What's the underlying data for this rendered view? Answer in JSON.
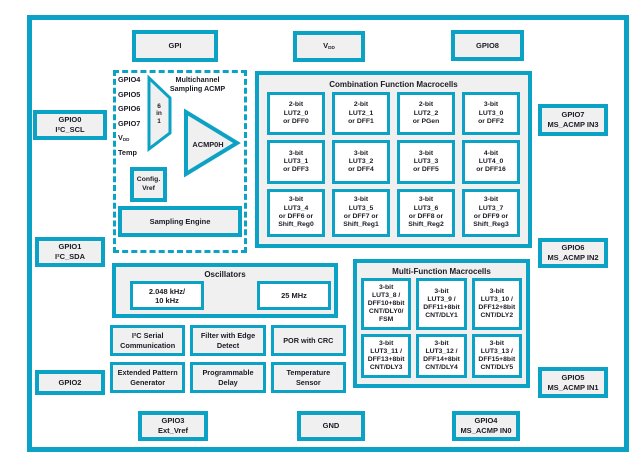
{
  "colors": {
    "accent": "#0ca2c6",
    "box_fill": "#f0f0f0",
    "cell_fill": "#ffffff",
    "text": "#1b1b26",
    "background": "#ffffff"
  },
  "pins": {
    "gpi": "GPI",
    "vdd_main": "V",
    "vdd_sub": "DD",
    "gpio8": "GPIO8",
    "gpio0": "GPIO0\nI²C_SCL",
    "gpio1": "GPIO1\nI²C_SDA",
    "gpio2": "GPIO2",
    "gpio3": "GPIO3\nExt_Vref",
    "gnd": "GND",
    "gpio4": "GPIO4\nMS_ACMP IN0",
    "gpio5": "GPIO5\nMS_ACMP IN1",
    "gpio6": "GPIO6\nMS_ACMP IN2",
    "gpio7": "GPIO7\nMS_ACMP IN3"
  },
  "acmp": {
    "title": "Multichannel\nSampling ACMP",
    "inputs": [
      {
        "main": "GPIO4",
        "sub": ""
      },
      {
        "main": "GPIO5",
        "sub": ""
      },
      {
        "main": "GPIO6",
        "sub": ""
      },
      {
        "main": "GPIO7",
        "sub": ""
      },
      {
        "main": "V",
        "sub": "DD"
      },
      {
        "main": "Temp",
        "sub": ""
      }
    ],
    "mux": "6\nin\n1",
    "comparator": "ACMP0H",
    "config_vref": "Config.\nVref",
    "sampling_engine": "Sampling Engine"
  },
  "comb": {
    "title": "Combination Function Macrocells",
    "cells": [
      "2-bit\nLUT2_0\nor DFF0",
      "2-bit\nLUT2_1\nor DFF1",
      "2-bit\nLUT2_2\nor PGen",
      "3-bit\nLUT3_0\nor DFF2",
      "3-bit\nLUT3_1\nor DFF3",
      "3-bit\nLUT3_2\nor DFF4",
      "3-bit\nLUT3_3\nor DFF5",
      "4-bit\nLUT4_0\nor DFF16",
      "3-bit\nLUT3_4\nor DFF6 or\nShift_Reg0",
      "3-bit\nLUT3_5\nor DFF7 or\nShift_Reg1",
      "3-bit\nLUT3_6\nor DFF8 or\nShift_Reg2",
      "3-bit\nLUT3_7\nor DFF9 or\nShift_Reg3"
    ]
  },
  "osc": {
    "title": "Oscillators",
    "cells": [
      "2.048 kHz/\n10 kHz",
      "25 MHz"
    ]
  },
  "mf": {
    "title": "Multi-Function Macrocells",
    "cells": [
      "3-bit\nLUT3_8 /\nDFF10+8bit\nCNT/DLY0/\nFSM",
      "3-bit\nLUT3_9 /\nDFF11+8bit\nCNT/DLY1",
      "3-bit\nLUT3_10 /\nDFF12+8bit\nCNT/DLY2",
      "3-bit\nLUT3_11 /\nDFF13+8bit\nCNT/DLY3",
      "3-bit\nLUT3_12 /\nDFF14+8bit\nCNT/DLY4",
      "3-bit\nLUT3_13 /\nDFF15+8bit\nCNT/DLY5"
    ]
  },
  "blocks": [
    "I²C Serial\nCommunication",
    "Filter with Edge\nDetect",
    "POR with CRC",
    "Extended Pattern\nGenerator",
    "Programmable\nDelay",
    "Temperature\nSensor"
  ]
}
